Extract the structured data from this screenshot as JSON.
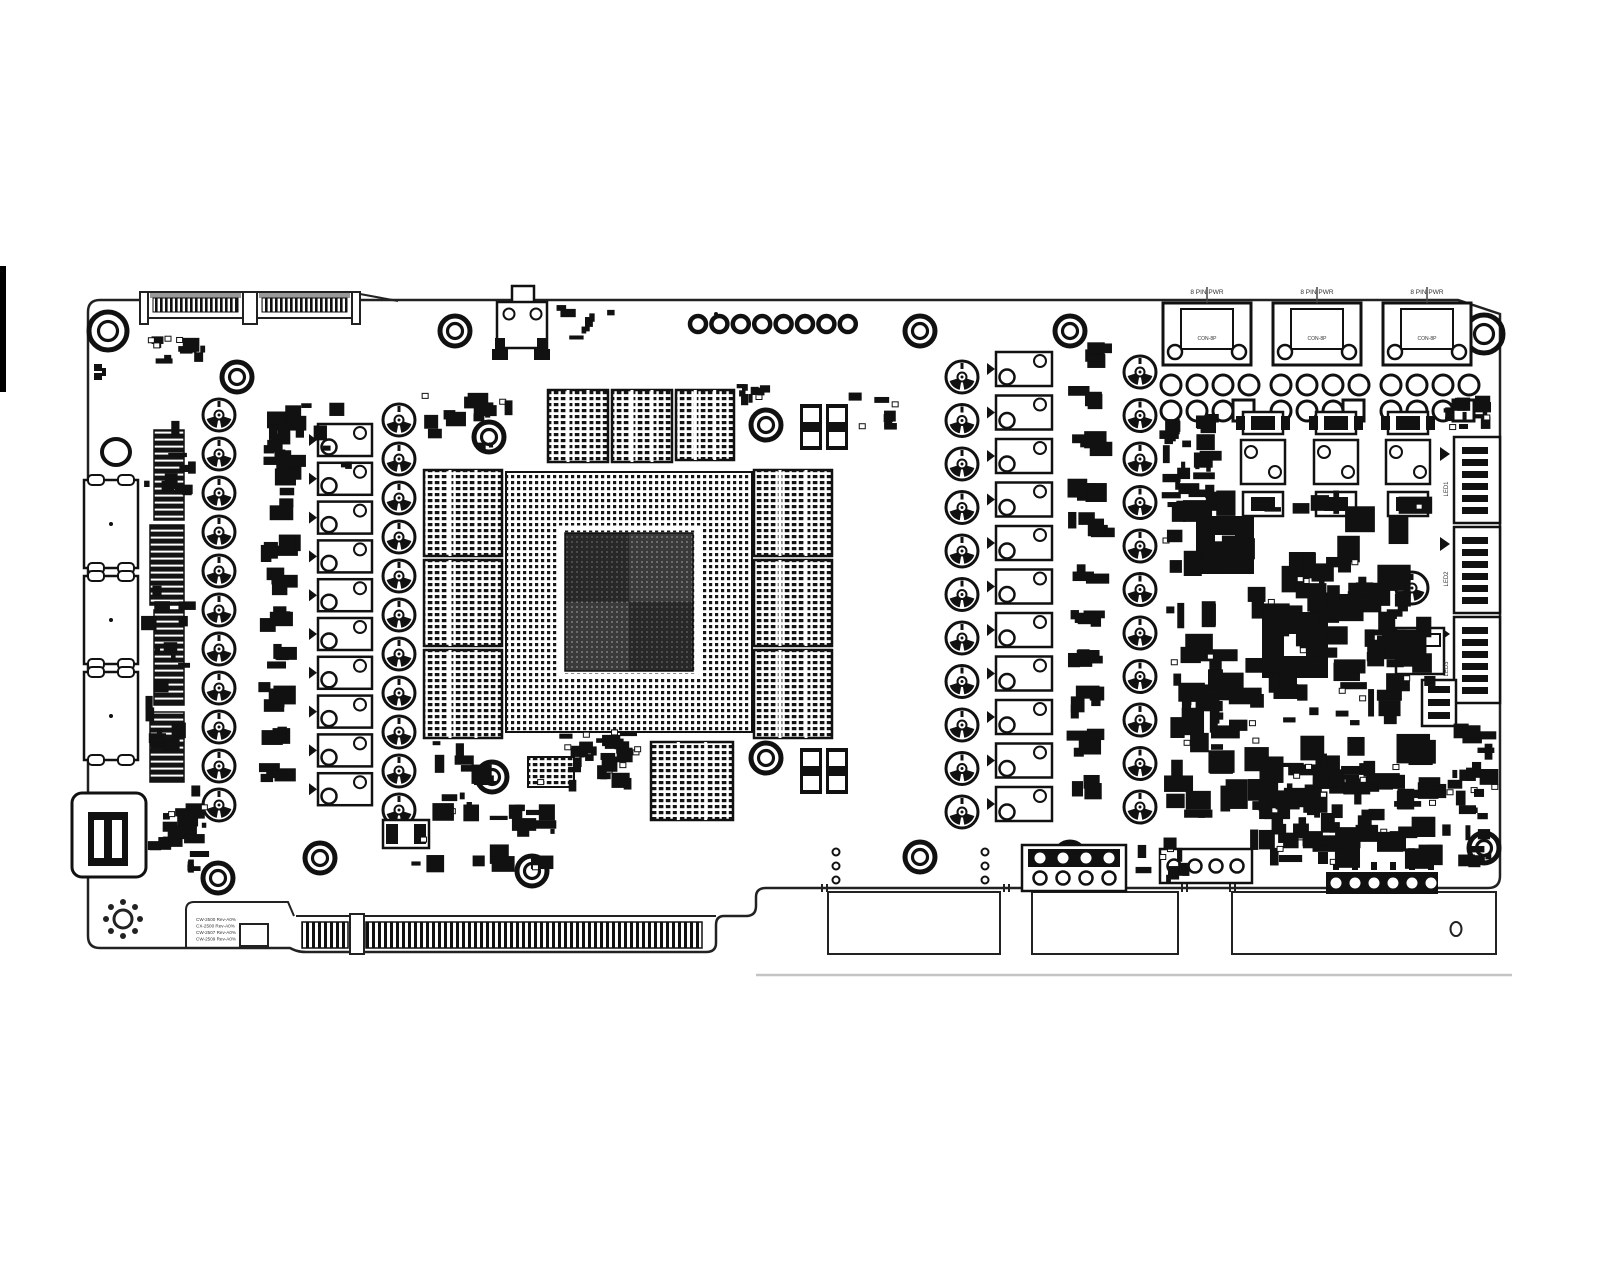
{
  "document": {
    "type": "PCB component placement diagram (top view)",
    "subject": "graphics card reference board",
    "background": "#ffffff",
    "ink": "#111111"
  },
  "board": {
    "memory_chips": 10,
    "vrm": {
      "left_phases": 10,
      "right_phases": 11,
      "left_caps": 11,
      "right_caps": 11
    },
    "mounting_holes": 16,
    "sli_finger_segments": 2,
    "pcie_edge_segments": 2,
    "display_outputs": {
      "displayport_count": 3,
      "hdmi_count": 1
    },
    "top_center_test_rings": 8
  },
  "power_connectors": [
    {
      "label": "8 PIN PWR",
      "inner_label": "CON-8P"
    },
    {
      "label": "8 PIN PWR",
      "inner_label": "CON-8P"
    },
    {
      "label": "8 PIN PWR",
      "inner_label": "CON-8P"
    }
  ],
  "right_edge_connectors": [
    {
      "label": "LED1"
    },
    {
      "label": "LED2"
    },
    {
      "label": "LED3"
    }
  ],
  "bottom_left_text": [
    "CW-2500 Rev-A0%",
    "CX-2500 Rev-A0%",
    "CW-2507 Rev-A0%",
    "CW-2509 Rev-A0%"
  ]
}
